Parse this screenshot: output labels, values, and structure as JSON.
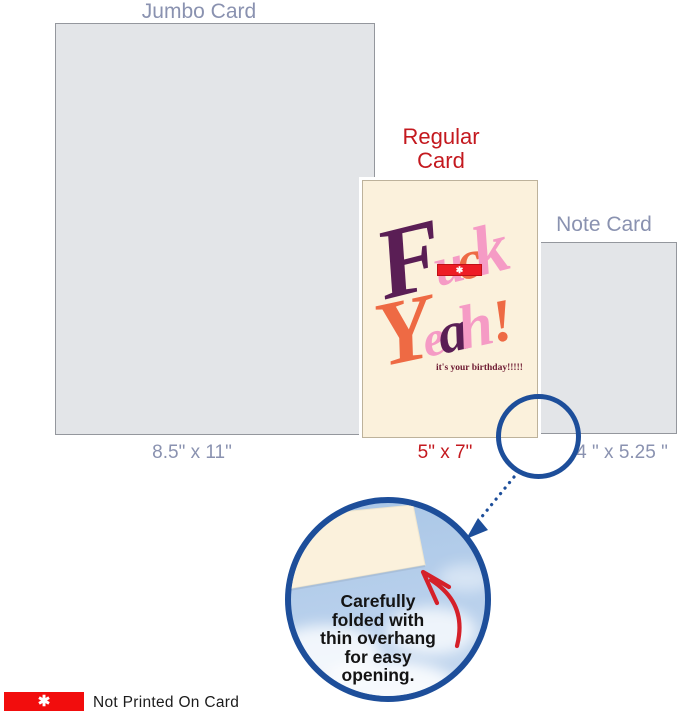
{
  "labels": {
    "jumbo": "Jumbo Card",
    "jumbo_size": "8.5\"  x 11\"",
    "regular_line1": "Regular",
    "regular_line2": "Card",
    "regular_size": "5\" x 7\"",
    "note": "Note Card",
    "note_size": "4 \" x 5.25 \""
  },
  "card_art": {
    "word1": [
      "F",
      "u",
      "c",
      "k"
    ],
    "word2": [
      "Y",
      "e",
      "a",
      "h",
      "!"
    ],
    "censor_symbol": "✱",
    "tagline": "it's your birthday!!!!!"
  },
  "callout": {
    "lines": [
      "Carefully",
      "folded with",
      "thin overhang",
      "for easy",
      "opening."
    ]
  },
  "legend": {
    "symbol": "✱",
    "text": "Not Printed On Card"
  },
  "colors": {
    "muted_label": "#8A92B0",
    "red_label": "#C4191F",
    "gray_card": "#E3E5E8",
    "cream_card": "#FBF1DC",
    "art_purple": "#5A1E55",
    "art_pink": "#F59BC5",
    "art_coral": "#EE6A44",
    "censor_red": "#EE1C25",
    "tagline_maroon": "#6E1A32",
    "circle_blue": "#1D4E9A",
    "sky_blue": "#AEC9E7",
    "arrow_red": "#D52029",
    "legend_red": "#F20D0D"
  }
}
